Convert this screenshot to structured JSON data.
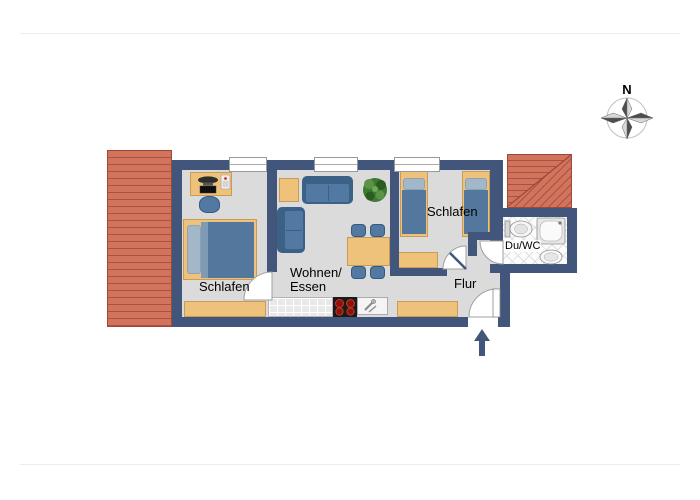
{
  "meta": {
    "type": "apartment-floor-plan"
  },
  "labels": {
    "bedroom_left": "Schlafen",
    "bedroom_right": "Schlafen",
    "living_line1": "Wohnen/",
    "living_line2": "Essen",
    "hallway": "Flur",
    "bathroom": "Du/WC",
    "compass_north": "N"
  },
  "colors": {
    "wall": "#42567C",
    "floor": "#DBDBDB",
    "terrace": "#D2745D",
    "terrace_line": "#AA5240",
    "terrace_border": "#9C4936",
    "wood": "#EFC27C",
    "wood_border": "#C99B55",
    "sofa": "#5179A2",
    "sofa_dark": "#3C6187",
    "duvet": "#54789D",
    "pillow": "#A2B7C7",
    "plant_green": "#3E7A33",
    "counter": "#E9E9E9",
    "cooktop": "#1A1A1A",
    "burner": "#8E1208",
    "tile_line": "#DEDEDE",
    "door_arc": "#A0A0A0"
  }
}
